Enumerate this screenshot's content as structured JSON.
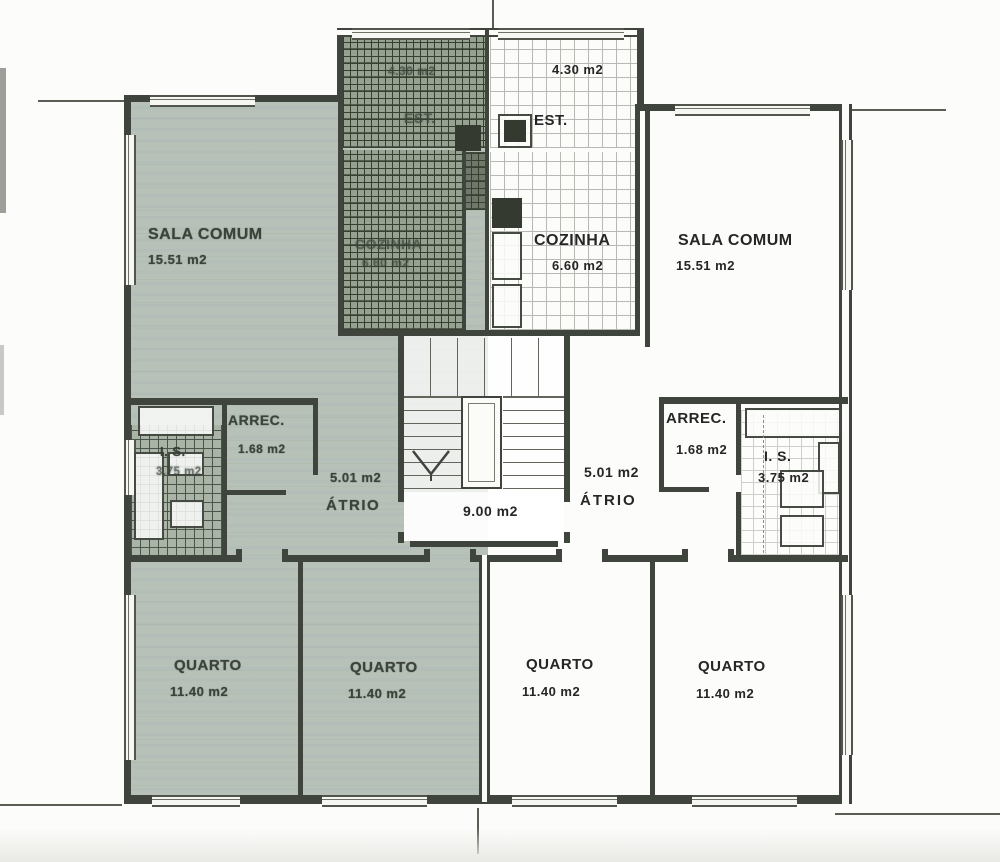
{
  "document": {
    "kind": "scanned architectural floor plan"
  },
  "stairwell": {
    "area": "9.00 m2"
  },
  "left_apartment": {
    "sala": {
      "name": "SALA COMUM",
      "area": "15.51 m2"
    },
    "cozinha": {
      "name": "COZINHA",
      "area": "6.60 m2"
    },
    "est": {
      "name": "EST.",
      "area": "4.30 m2"
    },
    "arrec": {
      "name": "ARREC.",
      "area": "1.68 m2"
    },
    "is": {
      "name": "I. S.",
      "area": "3.75 m2"
    },
    "atrio": {
      "name": "ÁTRIO",
      "area": "5.01 m2"
    },
    "quarto_a": {
      "name": "QUARTO",
      "area": "11.40 m2"
    },
    "quarto_b": {
      "name": "QUARTO",
      "area": "11.40 m2"
    }
  },
  "right_apartment": {
    "est": {
      "name": "EST.",
      "area": "4.30 m2"
    },
    "cozinha": {
      "name": "COZINHA",
      "area": "6.60 m2"
    },
    "sala": {
      "name": "SALA COMUM",
      "area": "15.51 m2"
    },
    "arrec": {
      "name": "ARREC.",
      "area": "1.68 m2"
    },
    "is": {
      "name": "I. S.",
      "area": "3.75 m2"
    },
    "atrio": {
      "name": "ÁTRIO",
      "area": "5.01 m2"
    },
    "quarto_c": {
      "name": "QUARTO",
      "area": "11.40 m2"
    },
    "quarto_d": {
      "name": "QUARTO",
      "area": "11.40 m2"
    }
  },
  "colors": {
    "wall": "#3f443c",
    "left_shade": "#b7c1b7",
    "paper": "#fcfcfa"
  }
}
